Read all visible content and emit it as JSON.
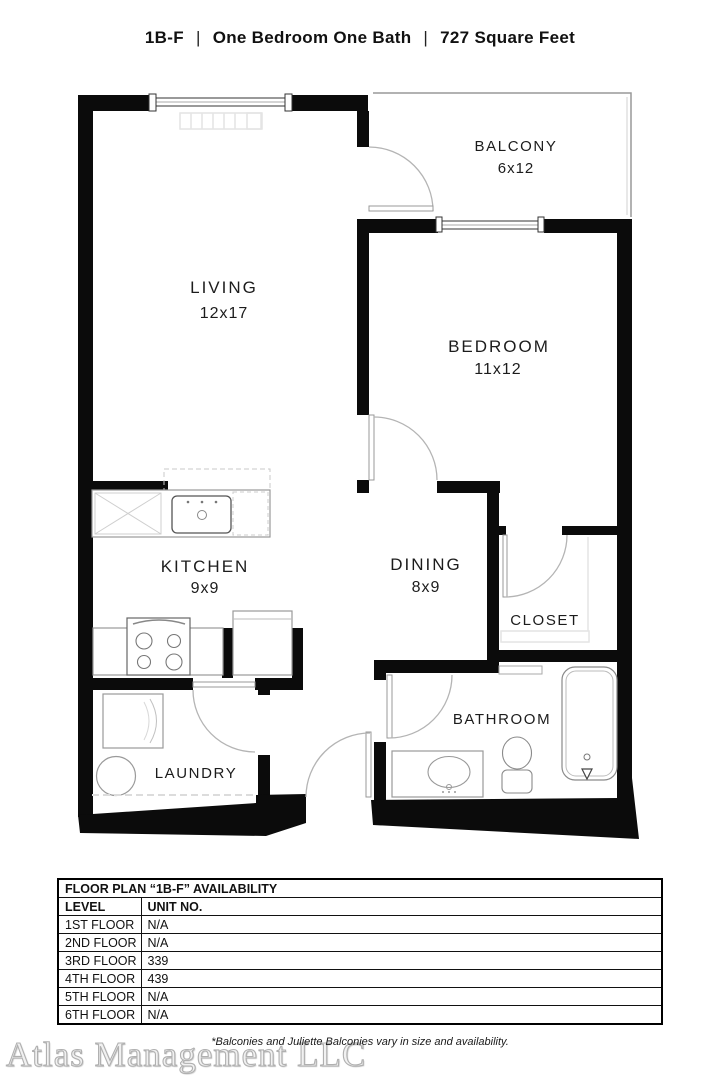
{
  "header": {
    "plan_code": "1B-F",
    "separator": "|",
    "description": "One Bedroom One Bath",
    "area": "727 Square Feet"
  },
  "rooms": {
    "balcony": {
      "label": "BALCONY",
      "dims": "6x12"
    },
    "living": {
      "label": "LIVING",
      "dims": "12x17"
    },
    "bedroom": {
      "label": "BEDROOM",
      "dims": "11x12"
    },
    "kitchen": {
      "label": "KITCHEN",
      "dims": "9x9"
    },
    "dining": {
      "label": "DINING",
      "dims": "8x9"
    },
    "closet": {
      "label": "CLOSET"
    },
    "bathroom": {
      "label": "BATHROOM"
    },
    "laundry": {
      "label": "LAUNDRY"
    }
  },
  "availability": {
    "title": "FLOOR PLAN “1B-F” AVAILABILITY",
    "headers": {
      "level": "LEVEL",
      "unit": "UNIT NO."
    },
    "rows": [
      {
        "level": "1ST FLOOR",
        "unit": "N/A"
      },
      {
        "level": "2ND FLOOR",
        "unit": "N/A"
      },
      {
        "level": "3RD FLOOR",
        "unit": "339"
      },
      {
        "level": "4TH FLOOR",
        "unit": "439"
      },
      {
        "level": "5TH FLOOR",
        "unit": "N/A"
      },
      {
        "level": "6TH FLOOR",
        "unit": "N/A"
      }
    ]
  },
  "footer": {
    "watermark": "Atlas Management LLC",
    "disclaimer": "*Balconies and Juliette Balconies vary in size and availability."
  },
  "colors": {
    "wall": "#0b0b0b",
    "fixture_line": "#9a9a9a",
    "door_arc": "#b4b4b4"
  }
}
